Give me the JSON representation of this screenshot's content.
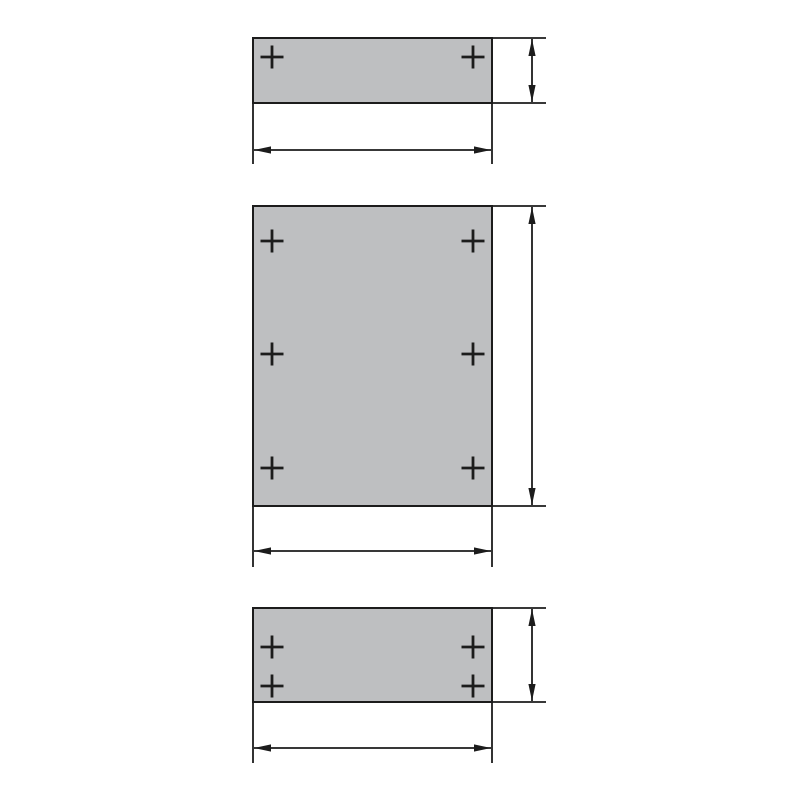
{
  "diagram": {
    "background": "#ffffff",
    "line_color": "#1c1c1c",
    "panel_fill": "#bebfc1",
    "panel_stroke_width": 2,
    "line_width": 1.8,
    "cross_size": 23,
    "cross_stroke_width": 2.8,
    "arrow_length": 17,
    "arrow_half_width": 3.6,
    "canvas": {
      "width": 800,
      "height": 800
    },
    "panels": [
      {
        "name": "top-panel",
        "rect": {
          "x": 253,
          "y": 38,
          "w": 239,
          "h": 65
        },
        "holes": [
          {
            "x": 272,
            "y": 57
          },
          {
            "x": 473,
            "y": 57
          }
        ],
        "edge_extensions": [
          {
            "x1": 492,
            "y1": 38,
            "x2": 546,
            "y2": 38
          },
          {
            "x1": 492,
            "y1": 103,
            "x2": 546,
            "y2": 103
          }
        ],
        "extension_lines": [
          {
            "x1": 253,
            "y1": 103,
            "x2": 253,
            "y2": 164
          },
          {
            "x1": 492,
            "y1": 103,
            "x2": 492,
            "y2": 164
          }
        ],
        "vertical_dimension": {
          "x": 532,
          "y1": 38,
          "y2": 103
        },
        "horizontal_dimension": {
          "y": 150,
          "x1": 253,
          "x2": 492
        }
      },
      {
        "name": "middle-panel",
        "rect": {
          "x": 253,
          "y": 206,
          "w": 239,
          "h": 300
        },
        "holes": [
          {
            "x": 272,
            "y": 241
          },
          {
            "x": 473,
            "y": 241
          },
          {
            "x": 272,
            "y": 354
          },
          {
            "x": 473,
            "y": 354
          },
          {
            "x": 272,
            "y": 468
          },
          {
            "x": 473,
            "y": 468
          }
        ],
        "edge_extensions": [
          {
            "x1": 492,
            "y1": 206,
            "x2": 546,
            "y2": 206
          },
          {
            "x1": 492,
            "y1": 506,
            "x2": 546,
            "y2": 506
          }
        ],
        "extension_lines": [
          {
            "x1": 253,
            "y1": 506,
            "x2": 253,
            "y2": 567
          },
          {
            "x1": 492,
            "y1": 506,
            "x2": 492,
            "y2": 567
          }
        ],
        "vertical_dimension": {
          "x": 532,
          "y1": 206,
          "y2": 506
        },
        "horizontal_dimension": {
          "y": 551,
          "x1": 253,
          "x2": 492
        }
      },
      {
        "name": "bottom-panel",
        "rect": {
          "x": 253,
          "y": 608,
          "w": 239,
          "h": 94
        },
        "holes": [
          {
            "x": 272,
            "y": 647
          },
          {
            "x": 473,
            "y": 647
          },
          {
            "x": 272,
            "y": 686
          },
          {
            "x": 473,
            "y": 686
          }
        ],
        "edge_extensions": [
          {
            "x1": 492,
            "y1": 608,
            "x2": 546,
            "y2": 608
          },
          {
            "x1": 492,
            "y1": 702,
            "x2": 546,
            "y2": 702
          }
        ],
        "extension_lines": [
          {
            "x1": 253,
            "y1": 702,
            "x2": 253,
            "y2": 763
          },
          {
            "x1": 492,
            "y1": 702,
            "x2": 492,
            "y2": 763
          }
        ],
        "vertical_dimension": {
          "x": 532,
          "y1": 608,
          "y2": 702
        },
        "horizontal_dimension": {
          "y": 748,
          "x1": 253,
          "x2": 492
        }
      }
    ]
  }
}
